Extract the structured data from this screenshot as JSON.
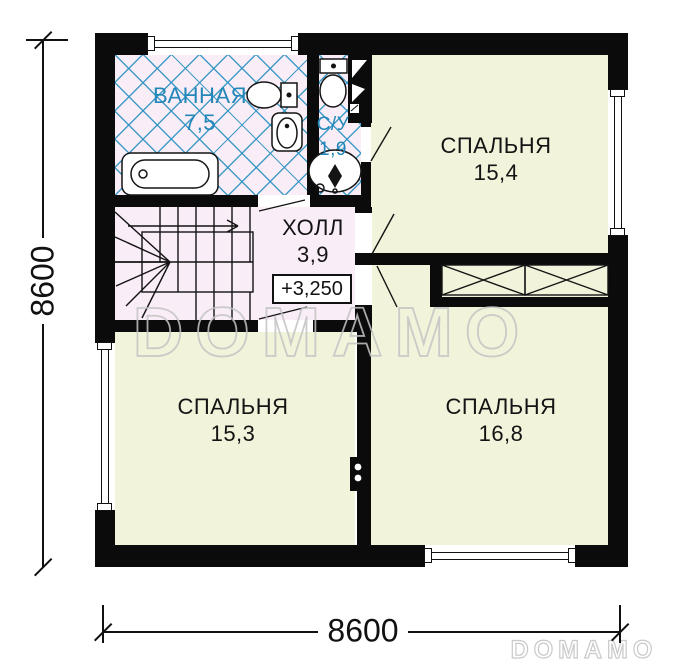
{
  "watermarks": {
    "center": "DOMAMO",
    "bottom_right": "DOMAMO"
  },
  "dimensions": {
    "left": "8600",
    "bottom": "8600"
  },
  "rooms": {
    "bathroom": {
      "name": "ВАННАЯ",
      "area": "7,5"
    },
    "wc": {
      "name": "С/У",
      "area": "1,9"
    },
    "hall": {
      "name": "ХОЛЛ",
      "area": "3,9",
      "elevation_mark": "+3,250"
    },
    "bedroom_top_right": {
      "name": "СПАЛЬНЯ",
      "area": "15,4"
    },
    "bedroom_bottom_left": {
      "name": "СПАЛЬНЯ",
      "area": "15,3"
    },
    "bedroom_bottom_right": {
      "name": "СПАЛЬНЯ",
      "area": "16,8"
    }
  },
  "fixtures": {
    "bathtub": "bathtub-icon",
    "bathroom_toilet": "toilet-icon",
    "bathroom_sink": "sink-icon",
    "wc_toilet": "toilet-icon",
    "wc_sink": "sink-icon",
    "staircase": "staircase-with-up-arrow",
    "vent_shaft": "vent-shaft-icon",
    "chimney_flue": "flue-icon",
    "wardrobe": "wardrobe-crossed-boxes"
  },
  "colors": {
    "wall": "#0b0b0b",
    "wet_room_floor": "#f9edf7",
    "bedroom_floor": "#f1f3da",
    "tile_line_blue": "#2d93c2",
    "wet_label_blue": "#2387b8",
    "text_dark": "#141414",
    "watermark_gray": "#c4c4c4"
  }
}
